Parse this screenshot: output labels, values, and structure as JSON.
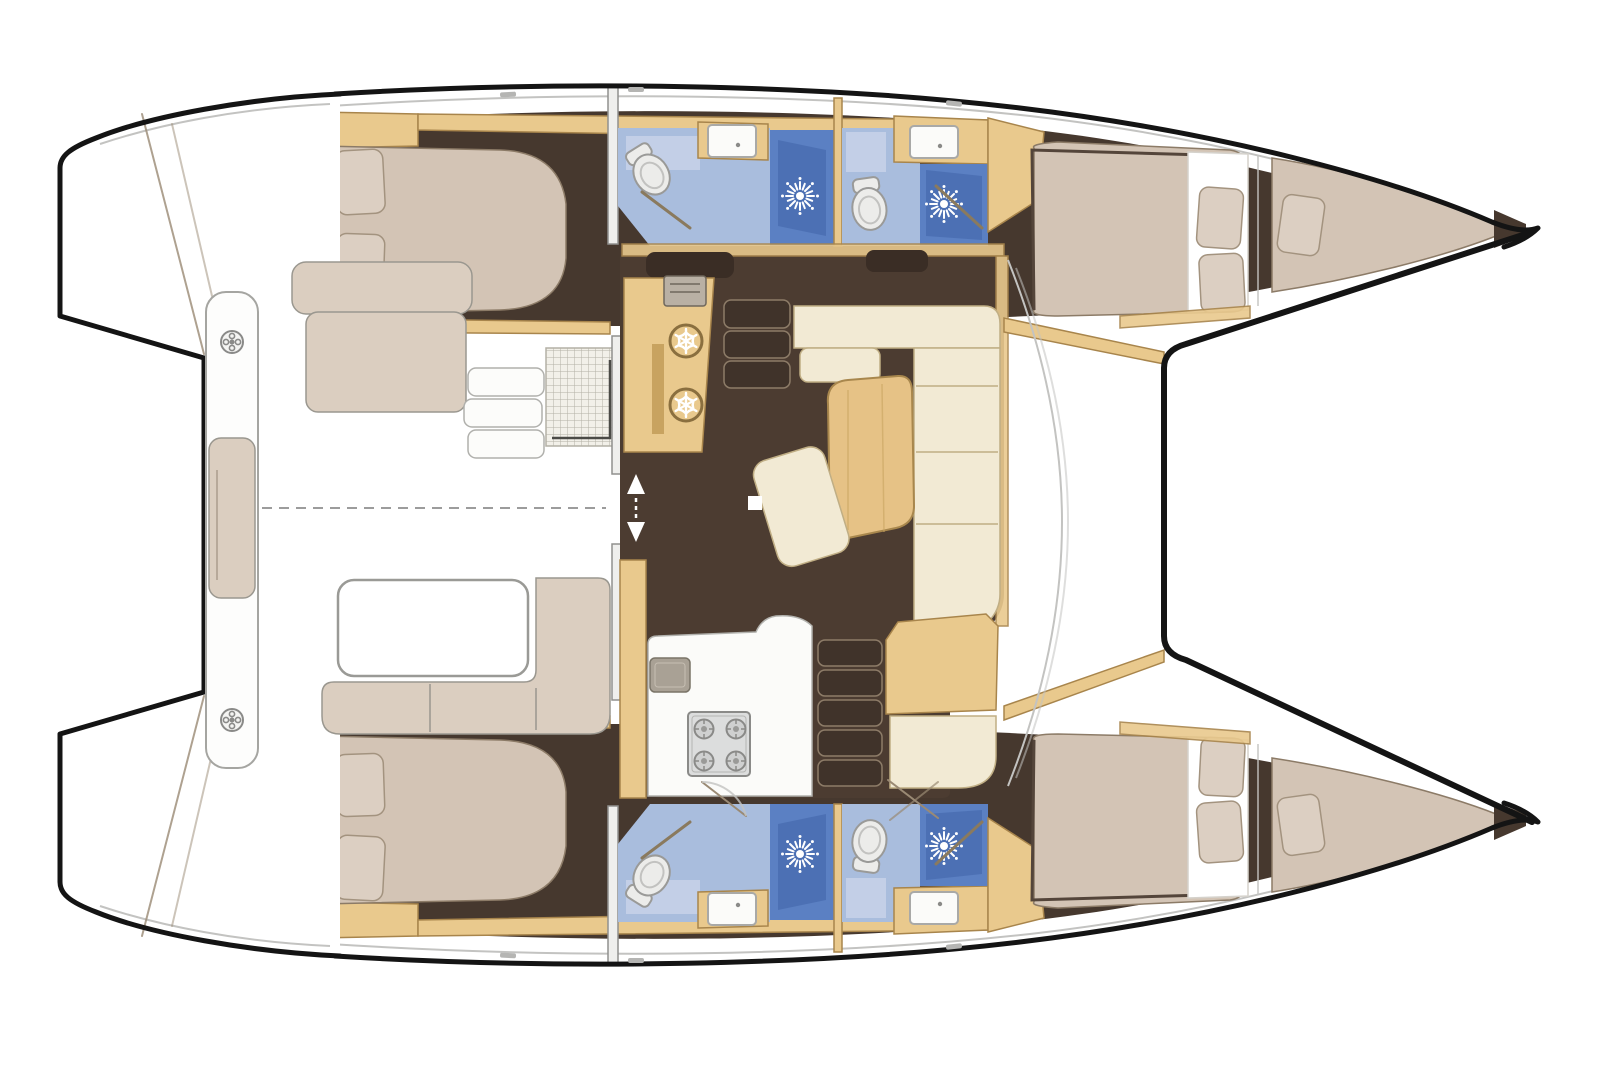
{
  "meta": {
    "type": "boat-interior-floor-plan",
    "subject": "sailing-catamaran",
    "view": "top-down",
    "bow_direction": "right",
    "visible_text": ""
  },
  "colors": {
    "paper": "#ffffff",
    "hull-outline": "#141414",
    "deck-line": "#c3c3c1",
    "hull-floor": "#46382e",
    "saloon-floor": "#4c3c31",
    "wood": "#e9c98d",
    "wood-dark": "#a8854c",
    "wood-stripe": "#c8a360",
    "bed": "#d3c4b5",
    "bed-edge": "#8c7b67",
    "pillow": "#dccfc2",
    "pillow-edge": "#a3937f",
    "cream": "#f2ead4",
    "cream-edge": "#c0ae84",
    "cushion": "#dbcec0",
    "cushion-edge": "#9a978f",
    "bath-floor": "#a9bddd",
    "bath-panel": "#c5d0e8",
    "shower-blue": "#5b80c3",
    "shower-blue-dark": "#4a6db1",
    "fixture-white": "#efefed",
    "fixture-edge": "#90908e",
    "steel": "#d8d9d9",
    "steel-edge": "#8a8a88",
    "step": "#40332a",
    "step-edge": "#8d7c68",
    "glass": "#8a7a5e",
    "door-line": "#9a8a74",
    "grate": "#f2f0e9",
    "grate-line": "#b3b0a5",
    "table-wood": "#e6c286",
    "table-edge": "#a8874d",
    "locker": "#3a2d25",
    "white": "#ffffff"
  },
  "areas": {
    "upper_hull": [
      "aft-double-cabin",
      "aft-head-with-shower",
      "forward-head-with-shower",
      "forward-double-cabin",
      "bow-berth"
    ],
    "lower_hull": [
      "aft-double-cabin",
      "aft-head-with-shower",
      "forward-head-with-shower",
      "forward-double-cabin",
      "bow-berth"
    ],
    "bridgedeck": [
      "saloon-l-sofa",
      "saloon-table",
      "ottoman",
      "fridge-freezer-cabinet",
      "galley-worktop",
      "four-burner-stove",
      "galley-sink",
      "hull-companionway-steps"
    ],
    "cockpit": [
      "transom-bench",
      "cockpit-table",
      "l-shaped-bench",
      "side-steps",
      "grate-locker",
      "sliding-door"
    ],
    "exterior": [
      "trampoline",
      "foredeck",
      "transom-platforms",
      "side-decks"
    ]
  },
  "fixtures": {
    "toilets": 4,
    "shower_stalls": 4,
    "sinks": 5,
    "stove_burners": 4,
    "fridge_drawers": 2,
    "winches": 2,
    "berths": 6,
    "step_flights": 3
  },
  "icons": [
    "snowflake-fridge-icon",
    "shower-head-icon",
    "toilet-icon",
    "sink-icon",
    "stove-burner-icon",
    "winch-icon",
    "sliding-door-arrows-icon"
  ]
}
